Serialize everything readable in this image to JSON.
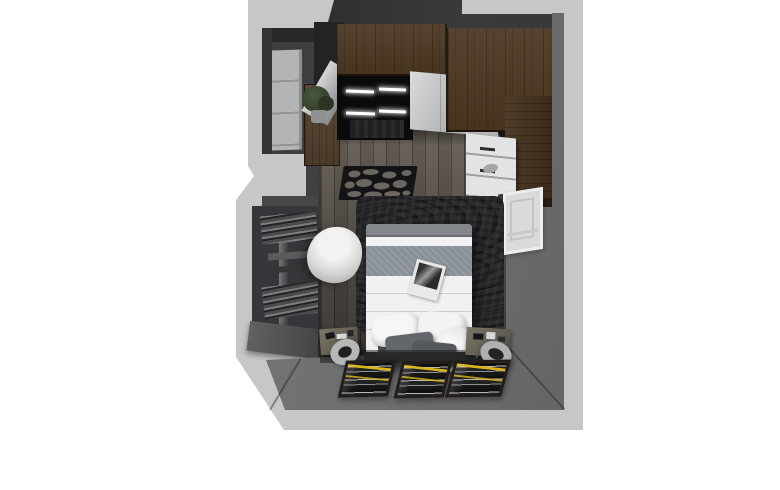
{
  "meta": {
    "type": "3d-floor-plan-render",
    "room": "bedroom",
    "view": "top-down"
  },
  "colors": {
    "background": "#ffffff",
    "wall_outer": "#c7c7c9",
    "wood": "#56432f",
    "closet_interior": "#0a0a0c",
    "led_white": "#ffffff",
    "drawer_white": "#e2e3e5",
    "door_gray": "#b3b4b6",
    "bed_white": "#f1f1f2",
    "bed_band": "#8a9098",
    "pillow_gray": "#63666b",
    "headboard": "#3b3c3e",
    "rug_black": "#0d0d0f",
    "mat_black": "#141416",
    "floor_hole": "#6b6660",
    "poster_frame": "#221d18",
    "poster_yellow": "#d9b418",
    "window_white": "#eceded",
    "cylinder": "#b6b7b9"
  },
  "scene": {
    "objects": [
      "entry-door-niche",
      "entry-door",
      "wood-counter",
      "potted-plant",
      "wardrobe-upper-cabinets",
      "wardrobe-open-section",
      "led-light-bars",
      "wardrobe-sliding-doors",
      "wardrobe-angled-door",
      "steel-side-panel",
      "drawer-unit",
      "tall-wood-cabinet",
      "decorative-cutout-mat",
      "plank-floor",
      "black-fur-rug",
      "double-bed",
      "duvet",
      "bed-runner",
      "white-pillows",
      "gray-throw-pillows",
      "magazine",
      "headboard",
      "left-nightstand",
      "right-nightstand",
      "cylinder-stool-left",
      "cylinder-stool-right",
      "framed-posters",
      "right-wall-window",
      "radiator",
      "window-bench",
      "beanbag-chair"
    ]
  }
}
